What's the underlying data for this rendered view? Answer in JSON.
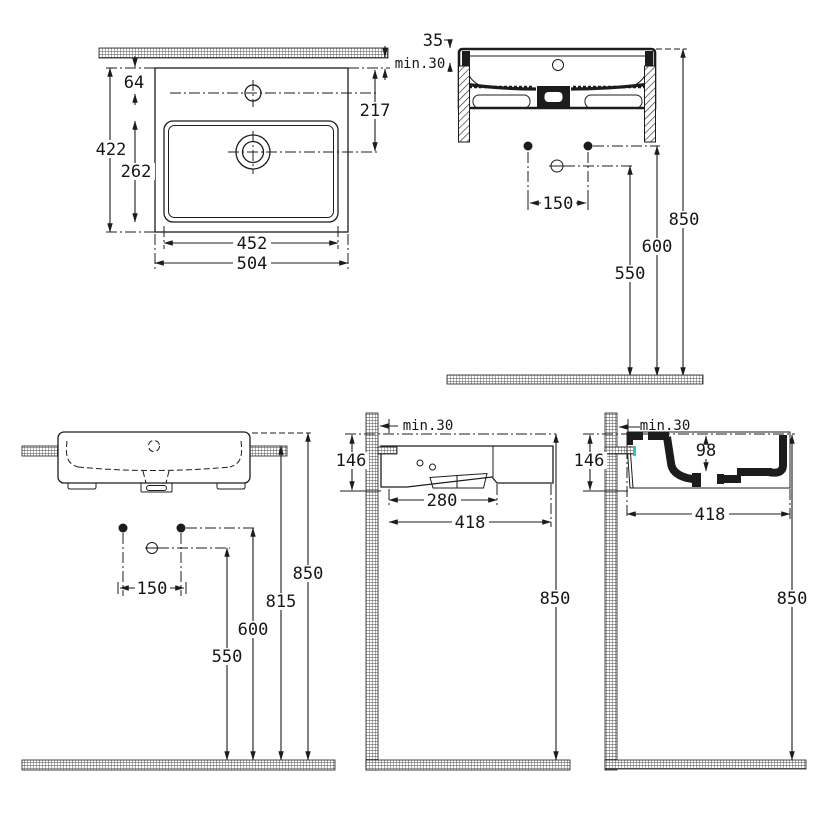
{
  "title": "washbasin-installation-drawing",
  "colors": {
    "ink": "#1c1c1c",
    "highlight": "#2ac6ce",
    "paper": "#ffffff"
  },
  "views": {
    "plan": {
      "min30": "min.30",
      "d64": "64",
      "d422": "422",
      "d262": "262",
      "d217": "217",
      "d452": "452",
      "d504": "504"
    },
    "front": {
      "d35": "35",
      "d150": "150",
      "d550": "550",
      "d600": "600",
      "d850": "850"
    },
    "front_installed": {
      "d150": "150",
      "d550": "550",
      "d600": "600",
      "d815": "815",
      "d850": "850"
    },
    "side": {
      "min30": "min.30",
      "d146": "146",
      "d280": "280",
      "d418": "418",
      "d850": "850"
    },
    "section": {
      "min30": "min.30",
      "d146": "146",
      "d98": "98",
      "d418": "418",
      "d850": "850"
    }
  }
}
